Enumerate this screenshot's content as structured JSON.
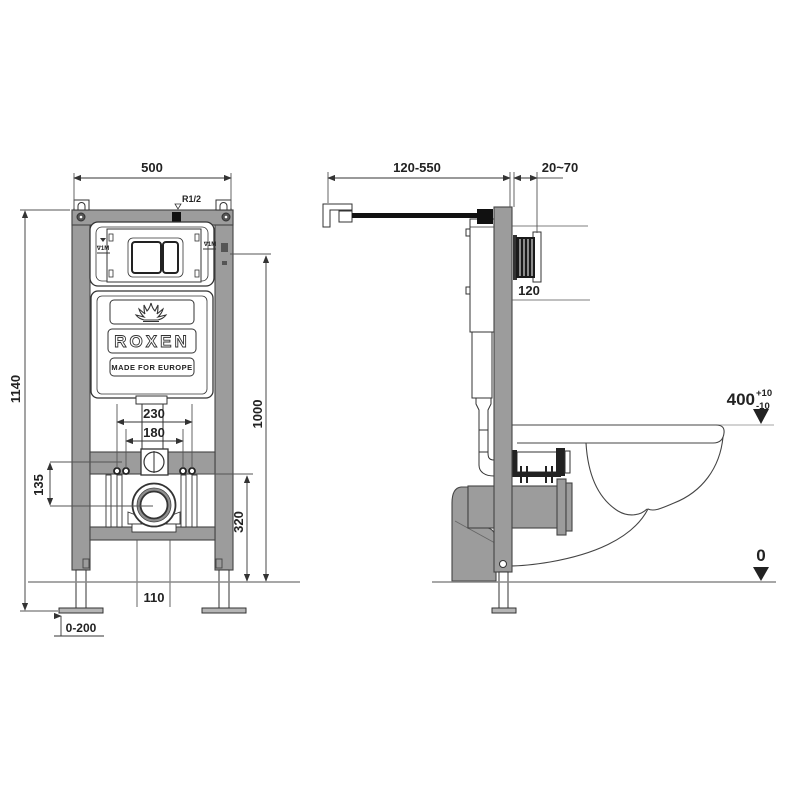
{
  "front_view": {
    "dim_width": "500",
    "dim_height": "1140",
    "dim_level": "1000",
    "dim_drain_to_floor": "320",
    "dim_inlet_to_drain": "135",
    "dim_bolts_outer": "230",
    "dim_bolts_inner": "180",
    "dim_outlet_width": "110",
    "dim_feet_range": "0-200",
    "label_water_inlet": "R1/2",
    "label_level_mark_left": "∇1M",
    "label_level_mark_right": "∇1M",
    "brand_name": "ROXEN",
    "brand_tagline": "MADE FOR EUROPE"
  },
  "side_view": {
    "dim_arm_range": "120-550",
    "dim_wall_thickness": "20~70",
    "dim_plate_opening": "120",
    "dim_rim_height": "400",
    "dim_rim_tol_plus": "+10",
    "dim_rim_tol_minus": "-10",
    "dim_floor_level": "0"
  },
  "colors": {
    "frame_gray": "#9c9c9c",
    "outline_dark": "#333333",
    "dim_line": "#555555",
    "floor_line": "#8a8a8a"
  }
}
